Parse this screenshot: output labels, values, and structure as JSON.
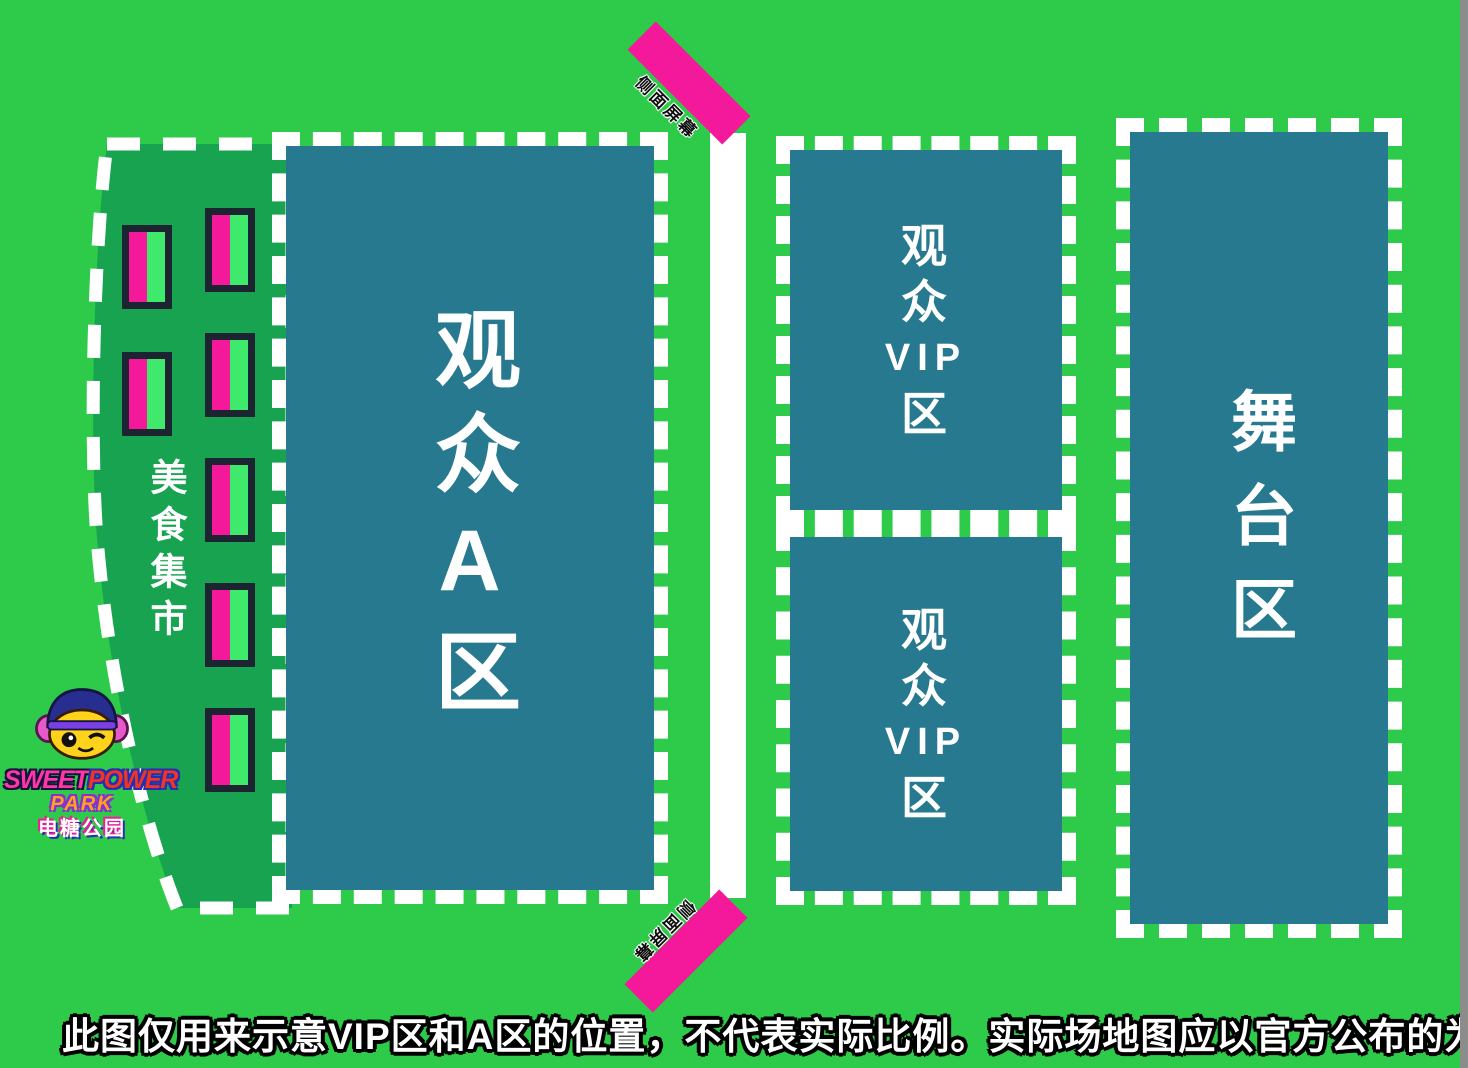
{
  "map": {
    "disclaimer": "此图仅用来示意VIP区和A区的位置，不代表实际比例。实际场地图应以官方公布的为准。",
    "zones": {
      "food_market": {
        "label": "美食集市",
        "booth_count": 7
      },
      "audience_a": {
        "label": "观众A区"
      },
      "vip_front": {
        "lines": [
          "观",
          "众",
          "VIP",
          "区"
        ]
      },
      "vip_rear": {
        "lines": [
          "观",
          "众",
          "VIP",
          "区"
        ]
      },
      "stage": {
        "label": "舞台区"
      },
      "side_screen_top": {
        "label": "侧面屏幕"
      },
      "side_screen_bottom": {
        "label": "侧面屏幕"
      }
    },
    "logo": {
      "brand_word_1": "SWEET",
      "brand_word_2": "POWER",
      "brand_word_3": "PARK",
      "brand_cn": "电糖公园"
    },
    "colors": {
      "background_green": "#2ecb4a",
      "market_green": "#17a350",
      "zone_teal": "#26798f",
      "accent_pink": "#f4189a",
      "booth_green": "#3ee96c",
      "booth_border": "#1c2331",
      "dash_white": "#ffffff"
    }
  }
}
